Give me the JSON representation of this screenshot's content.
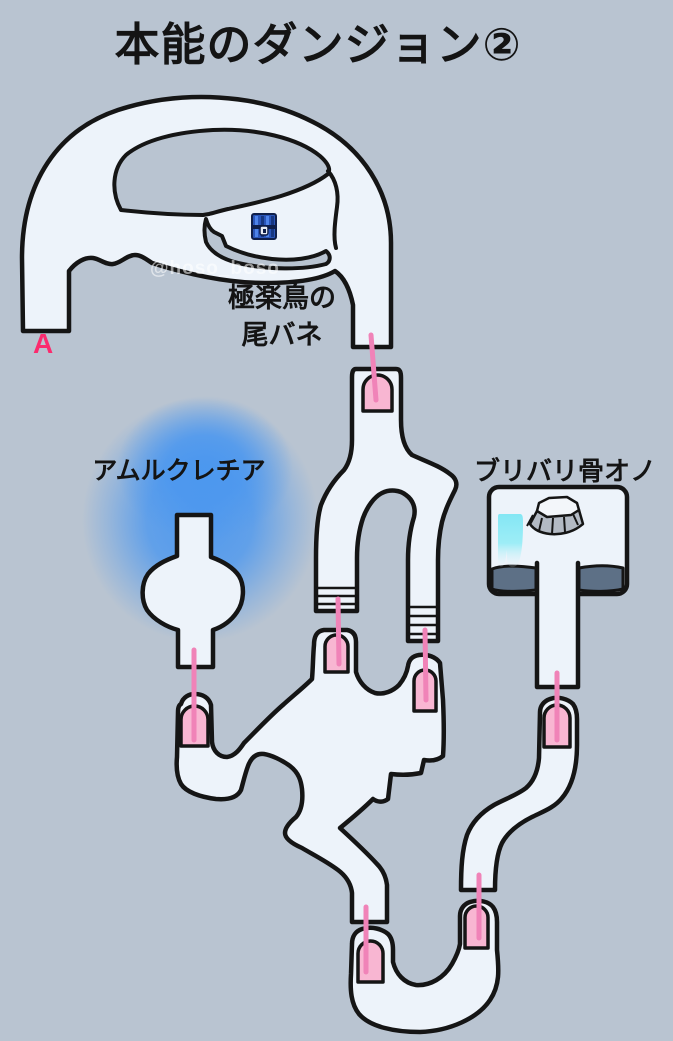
{
  "title": "本能のダンジョン②",
  "watermark": "@hoso_boso",
  "labels": {
    "entrance_a": "A",
    "feather_line1": "極楽鳥の",
    "feather_line2": "尾バネ",
    "amurukurechia": "アムルクレチア",
    "bone_axe": "ブリバリ骨オノ"
  },
  "map": {
    "door_marker_count": 7,
    "stair_marker_count": 2,
    "icons": [
      "treasure-chest-icon",
      "stump-icon",
      "waterfall-icon",
      "blue-glow"
    ]
  },
  "colors": {
    "bg": "#b9c4d1",
    "corridor": "#edf3fa",
    "outline": "#151515",
    "door-pink": "#f8b6d2",
    "line-pink": "#f083b8",
    "accent-pink-red": "#fb2b6e",
    "glow-blue": "#4b97ef",
    "waterfall-cyan": "#7ee6f4",
    "ledge-dark": "#5d7086",
    "text": "#141414",
    "watermark": "rgba(255,255,255,0.55)"
  }
}
